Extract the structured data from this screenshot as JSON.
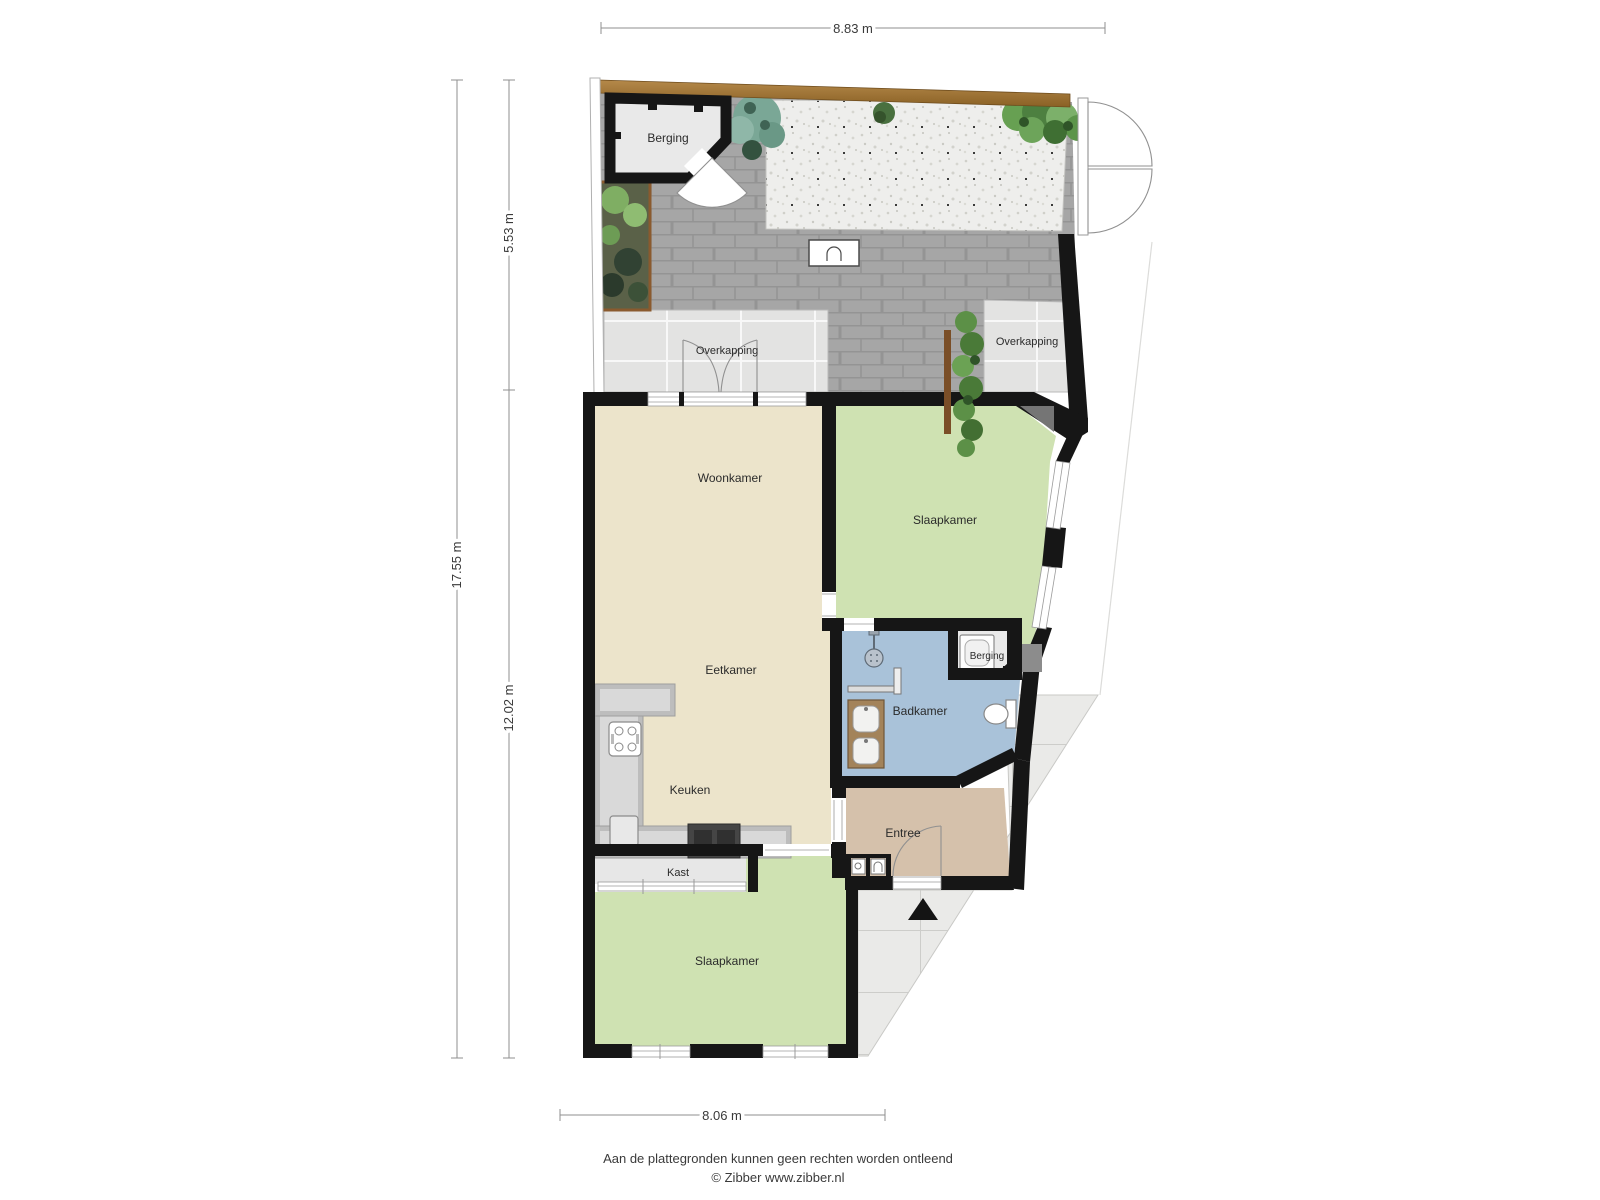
{
  "title": "Begane grond plattegrond",
  "dimensions": {
    "top": "8.83 m",
    "left_total": "17.55 m",
    "left_upper": "5.53 m",
    "left_lower": "12.02 m",
    "bottom": "8.06 m"
  },
  "rooms": {
    "berging_garden": "Berging",
    "overkapping_left": "Overkapping",
    "overkapping_right": "Overkapping",
    "woonkamer": "Woonkamer",
    "slaapkamer_boven": "Slaapkamer",
    "eetkamer": "Eetkamer",
    "badkamer": "Badkamer",
    "berging_klein": "Berging",
    "keuken": "Keuken",
    "entree": "Entree",
    "kast": "Kast",
    "slaapkamer_onder": "Slaapkamer"
  },
  "footer": {
    "disclaimer": "Aan de plattegronden kunnen geen rechten worden ontleend",
    "credit": "© Zibber www.zibber.nl"
  },
  "colors": {
    "wall": "#161616",
    "living_floor": "#ece4cb",
    "bedroom_floor": "#cfe2b2",
    "bathroom_floor": "#a9c2d9",
    "entry_floor": "#d5c1ab",
    "storage_floor": "#e9e9e9",
    "closet_floor": "#e7e7e7",
    "patio_tile": "#e3e3e2",
    "brick_paving": "#a6a6a6",
    "gravel": "#eeeeec",
    "wood_edge": "#a5793c",
    "hedge_green": "#5c9047",
    "driveway_tile": "#eaeae8",
    "counter_grey": "#bdbdbd",
    "island_dark": "#454545",
    "vanity_brown": "#a3835a"
  }
}
